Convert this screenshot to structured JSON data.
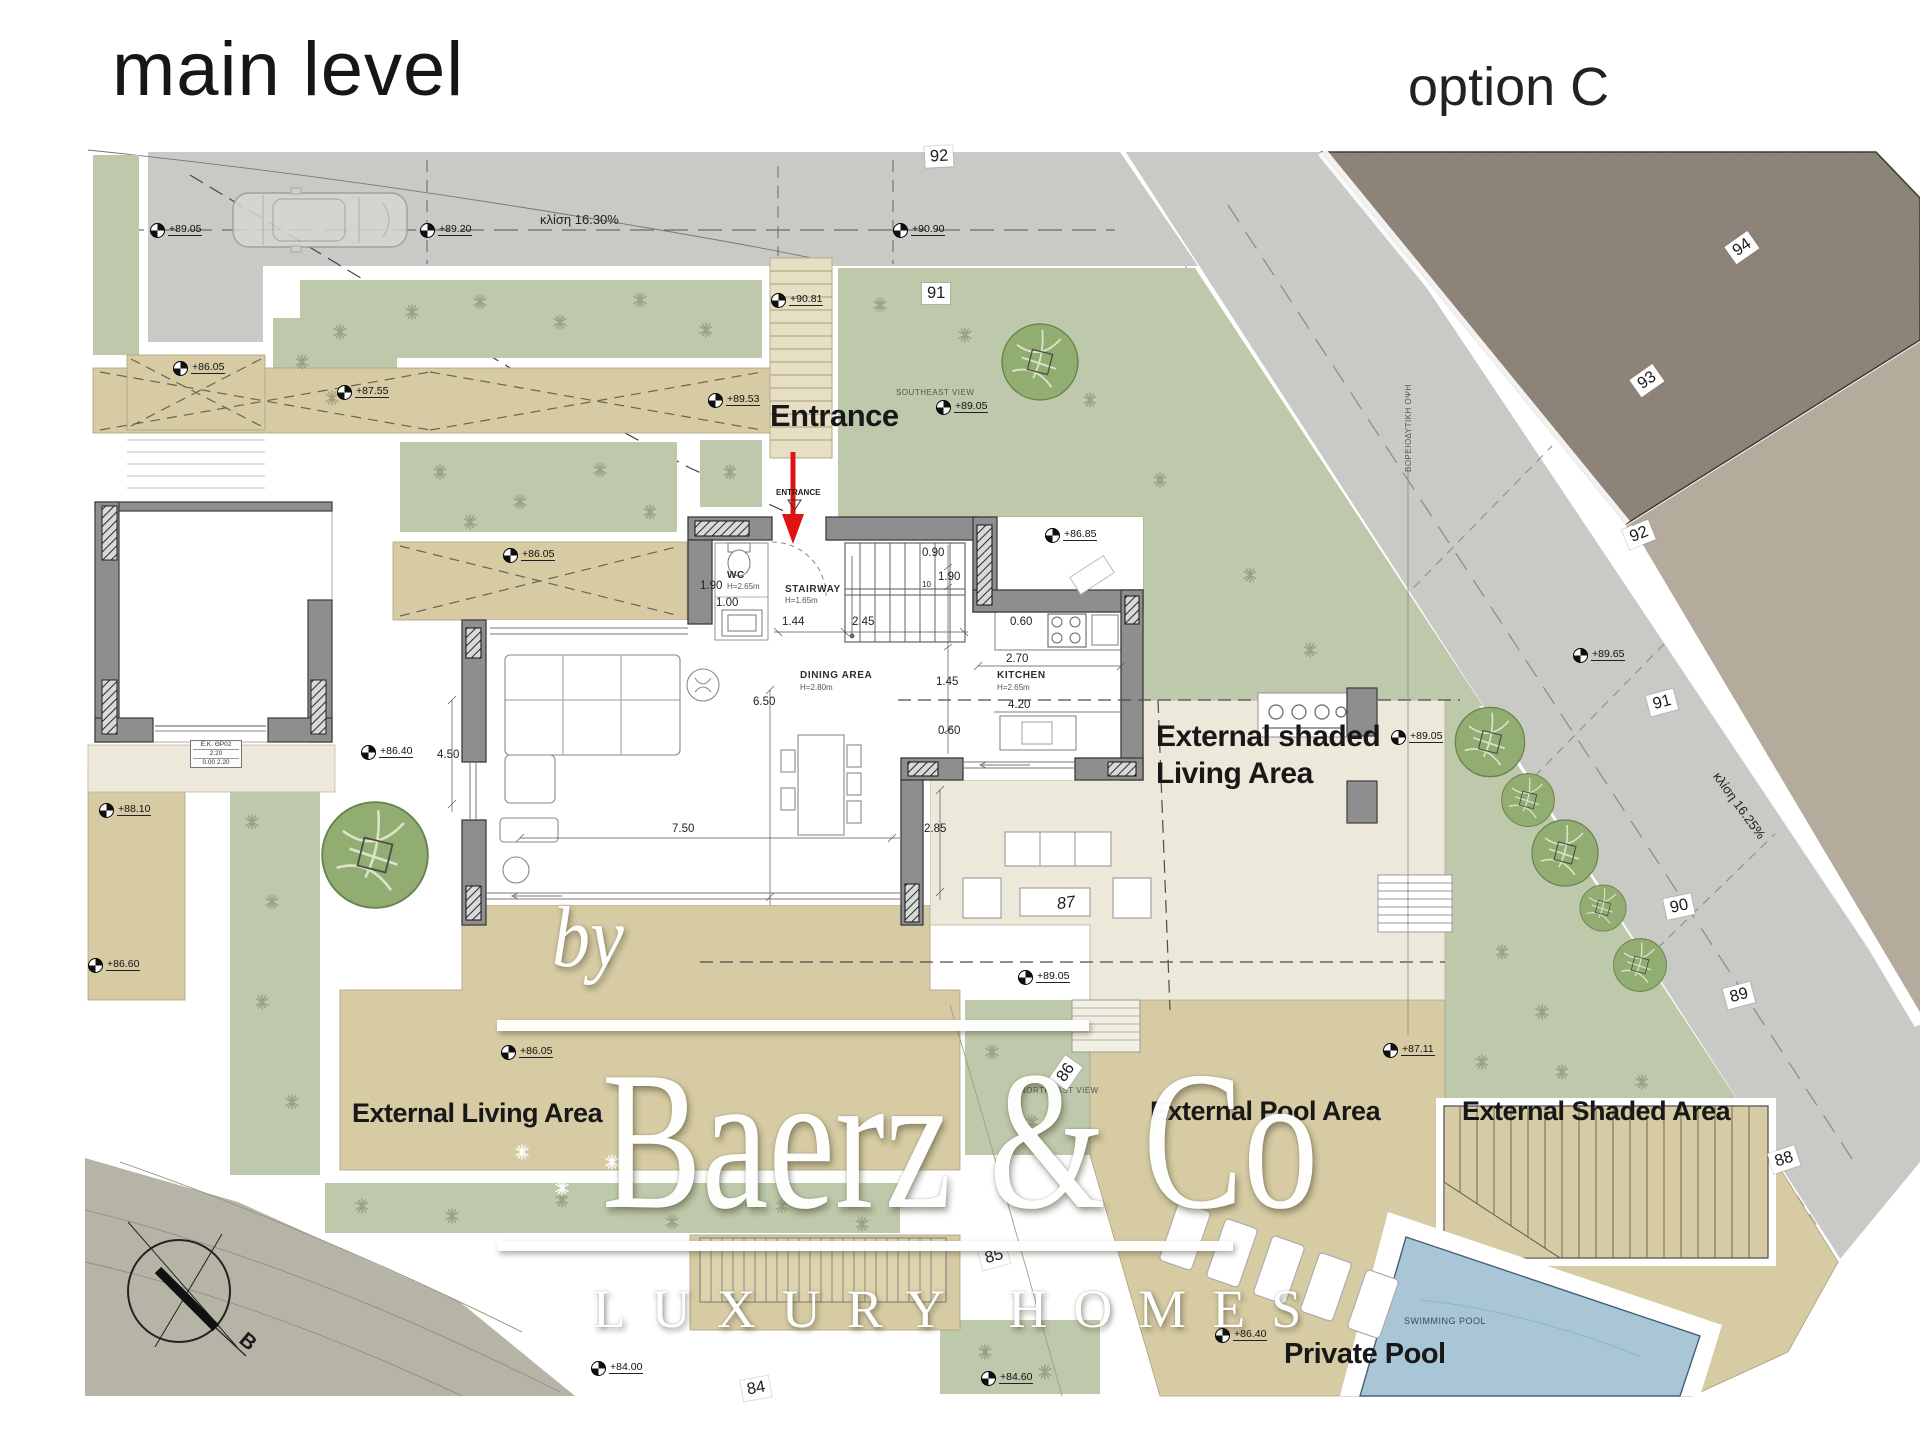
{
  "header": {
    "title": "main level",
    "option": "option C"
  },
  "area_labels": {
    "entrance": "Entrance",
    "external_shaded_living_1": "External shaded",
    "external_shaded_living_2": "Living Area",
    "external_living": "External Living Area",
    "external_pool": "External Pool Area",
    "external_shaded": "External Shaded Area",
    "private_pool": "Private Pool"
  },
  "room_labels": {
    "wc": "WC",
    "wc_h": "H=2.65m",
    "stairway": "STAIRWAY",
    "stairway_h": "H=1.65m",
    "dining": "DINING AREA",
    "dining_h": "H=2.80m",
    "kitchen": "KITCHEN",
    "kitchen_h": "H=2.65m",
    "entrance_small": "ENTRANCE"
  },
  "annotations": {
    "slope_top": "κλίση 16.30%",
    "slope_road": "κλίση 16.25%",
    "view_nw": "ΒΟΡΕΙΟΔΥΤΙΚΗ ΟΨΗ",
    "view_se": "SOUTHEAST VIEW",
    "view_ne": "NORTHEAST VIEW",
    "swimming_pool": "SWIMMING POOL",
    "compass_north": "B"
  },
  "door_tag": [
    "E.K. ΘΡ02",
    "2.20",
    "0.00  2.20"
  ],
  "elevation_markers": [
    "+89.05",
    "+89.20",
    "+90.90",
    "+90.81",
    "+87.55",
    "+86.05",
    "+89.53",
    "+89.05",
    "+86.85",
    "+86.05",
    "+86.40",
    "+88.10",
    "+86.60",
    "+89.65",
    "+89.05",
    "+89.05",
    "+86.05",
    "+87.11",
    "+86.40",
    "+84.60",
    "+84.00"
  ],
  "contour_tags": [
    "92",
    "91",
    "94",
    "93",
    "92",
    "91",
    "90",
    "89",
    "88",
    "87",
    "86",
    "85",
    "84"
  ],
  "dimensions": [
    "1.90",
    "1.00",
    "1.44",
    "2.45",
    "0.90",
    "1.90",
    "10",
    "0.60",
    "2.70",
    "1.45",
    "4.20",
    "0.60",
    "6.50",
    "4.50",
    "7.50",
    "2.85"
  ],
  "watermark": {
    "by": "by",
    "brand": "Baerz & Co",
    "tagline": "LUXURY HOMES"
  },
  "colors": {
    "road_gray": "#c9c9c6",
    "neighbor_plot": "#8d8378",
    "far_plot_tan": "#b5ab9c",
    "garden_green": "#bdc9aa",
    "tree_green": "#92ad72",
    "terrace_khaki": "#d6cba3",
    "terrace_cream": "#ece9da",
    "ground_olive": "#b5b4a6",
    "pool_blue": "#a9c6d6",
    "wall_gray": "#8e8e8e",
    "entrance_arrow_red": "#e01313"
  }
}
